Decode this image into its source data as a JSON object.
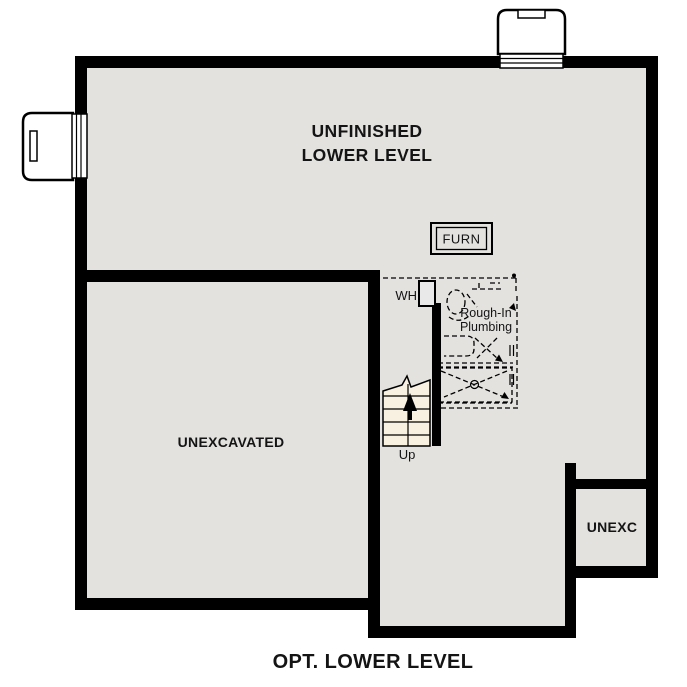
{
  "plan": {
    "rooms": {
      "unfinished_lower_level": {
        "label_line1": "UNFINISHED",
        "label_line2": "LOWER LEVEL"
      },
      "unexcavated": {
        "label": "UNEXCAVATED"
      },
      "unexc": {
        "label": "UNEXC"
      }
    },
    "fixtures": {
      "furnace": {
        "label": "FURN"
      },
      "water_heater": {
        "label": "WH"
      },
      "rough_in_plumbing": {
        "label_line1": "Rough-In",
        "label_line2": "Plumbing"
      },
      "stairs": {
        "label": "Up"
      }
    },
    "caption": "OPT. LOWER LEVEL",
    "colors": {
      "wall": "#000000",
      "floor": "#e4e2df",
      "stair_tread": "#f8f1e1",
      "fixture_fill": "#e9e9e9",
      "background": "#ffffff"
    }
  }
}
